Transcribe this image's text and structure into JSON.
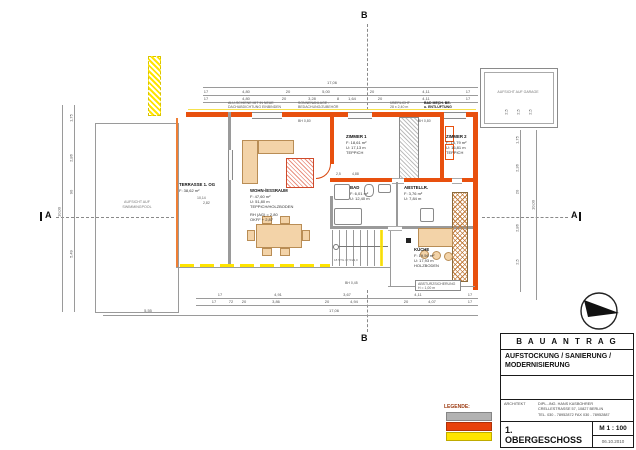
{
  "sheet": {
    "section_marker_a": "A",
    "section_marker_b": "B"
  },
  "plan": {
    "pool_label_1": "AUFSICHT AUF",
    "pool_label_2": "SWIMMINGPOOL",
    "garage_label": "AUFSICHT AUF GARAGE",
    "terrace": {
      "name": "TERRASSE 1. OG",
      "area": "F:  38,62 m²",
      "d1": "10,14",
      "d2": "2,82"
    },
    "rooms": [
      {
        "name": "WOHN-/ESSRAUM",
        "l1": "F:  47,60 m²",
        "l2": "U:  51,80 m",
        "l3": "TEPPICH/HOLZBODEN",
        "l4": "RH (AG) = 2,80",
        "l5": "OKFF + 2,87"
      },
      {
        "name": "ZIMMER 1",
        "l1": "F:  18,61 m²",
        "l2": "U:  17,13 m",
        "l3": "TEPPICH"
      },
      {
        "name": "ZIMMER 2",
        "l1": "F:  16,79 m²",
        "l2": "U:  16,81 m",
        "l3": "TEPPICH"
      },
      {
        "name": "BAD",
        "l1": "F:  6,01 m²",
        "l2": "U:  12,40 m"
      },
      {
        "name": "ABSTELLR.",
        "l1": "F:  3,76 m²",
        "l2": "U:  7,84 m"
      },
      {
        "name": "KÜCHE",
        "l1": "F:  19,56 m²",
        "l2": "U:  17,93 m",
        "l3": "HOLZBODEN"
      }
    ],
    "stair_label": "18 STG 17,5/29,0",
    "annotations": {
      "a1l1": "ALU-SCHIENE MIT IN NEUE",
      "a1l2": "DACHABDICHTUNG EINBINDEN",
      "a2l1": "SONNENANLAGE -",
      "a2l2": "BEDACHUNG/ZUBEHÖR",
      "a3l1": "ÜBERLICHT",
      "a3l2": "28 x 2,40 m",
      "a4l1": "BAD MECH. BE-",
      "a4l2": "u. ENTLÜFTUNG",
      "bh_left": "BH 0,80",
      "bh_right": "BH 0,80",
      "bh_bottom": "BH 0,45",
      "guard1": "ABSTURZSICHERUNG",
      "guard2": "H = 1,00 m"
    }
  },
  "dims": {
    "top_total": "17,06",
    "top_row1": [
      "17",
      "4,80",
      "20",
      "5,00",
      "20",
      "4,11",
      "17"
    ],
    "top_row2": [
      "17",
      "4,80",
      "20",
      "3,28",
      "8",
      "1,64",
      "20",
      "4,11",
      "17"
    ],
    "bottom_row1": [
      "17",
      "4,91",
      "3,67",
      "4,11",
      "17"
    ],
    "bottom_row2": [
      "17",
      "72",
      "20",
      "3,86",
      "20",
      "4,94",
      "20",
      "4,07",
      "17"
    ],
    "bottom_left_total": "5,55",
    "bottom_right_total": "17,06",
    "left_chain": [
      "1,75",
      "2,86",
      "90",
      "5,49"
    ],
    "left_total": "10,00",
    "right_chain": [
      "1,75",
      "2,36",
      "20",
      "2,86",
      "2,5"
    ],
    "right_total": "10,00",
    "garage_chain": [
      "2,5",
      "2,5",
      "2,5"
    ],
    "red1": "2,5",
    "red2": "4,88"
  },
  "legend": {
    "title": "LEGENDE:",
    "items": [
      {
        "label": "BESTAND",
        "color": "#b2b2b2"
      },
      {
        "label": "NEU",
        "color": "#e8420b"
      },
      {
        "label": "ABBRUCH",
        "color": "#ffe400"
      }
    ]
  },
  "title_block": {
    "header": "B A U A N T R A G",
    "project": "AUFSTOCKUNG / SANIERUNG / MODERNISIERUNG",
    "architect_label": "ARCHITEKT",
    "architect_1": "DIPL.-ING. HANS KASBOHRER",
    "architect_2": "CRELLESTRASSE 57, 10827 BERLIN",
    "architect_3": "TEL. 030 - 78952872  FAX 030 - 78952887",
    "sheet_title": "1. OBERGESCHOSS",
    "scale": "M 1 : 100",
    "date": "06.10.2010"
  }
}
